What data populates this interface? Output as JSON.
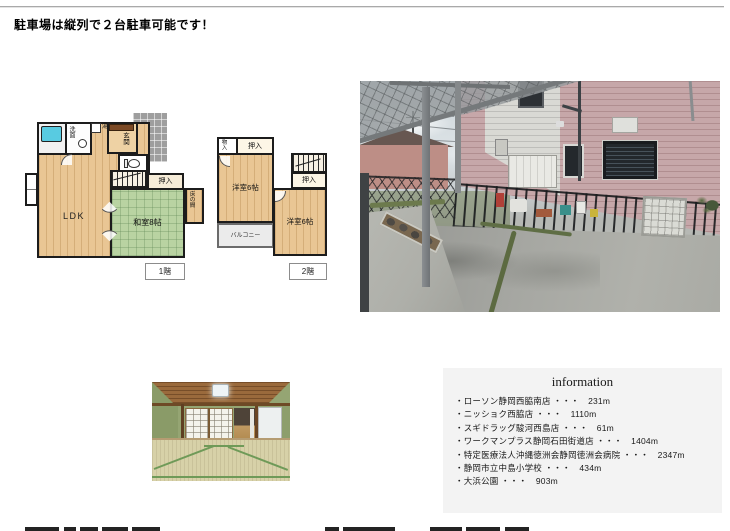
{
  "header": {
    "title": "駐車場は縦列で２台駐車可能です！"
  },
  "floorplans": {
    "floor1": {
      "label": "1階",
      "ldk": "LDK",
      "washitsu": "和室8帖",
      "oshiire": "押入",
      "tokonoma": "床の間",
      "genkan": "玄関",
      "senmen": "洗面",
      "yu": "湯"
    },
    "floor2": {
      "label": "2階",
      "monoire": "物入",
      "oshiire_top": "押入",
      "yoshitsu_left": "洋室6帖",
      "oshiire_right": "押入",
      "yoshitsu_right": "洋室6帖",
      "balcony": "バルコニー"
    }
  },
  "information": {
    "title": "information",
    "bullet": "・",
    "separator": "・・・",
    "items": [
      {
        "name": "ローソン静岡西脇南店",
        "distance": "231m"
      },
      {
        "name": "ニッショク西脇店",
        "distance": "1110m"
      },
      {
        "name": "スギドラッグ駿河西島店",
        "distance": "61m"
      },
      {
        "name": "ワークマンプラス静岡石田街道店",
        "distance": "1404m"
      },
      {
        "name": "特定医療法人沖縄徳洲会静岡徳洲会病院",
        "distance": "2347m"
      },
      {
        "name": "静岡市立中島小学校",
        "distance": "434m"
      },
      {
        "name": "大浜公園",
        "distance": "903m"
      }
    ]
  }
}
